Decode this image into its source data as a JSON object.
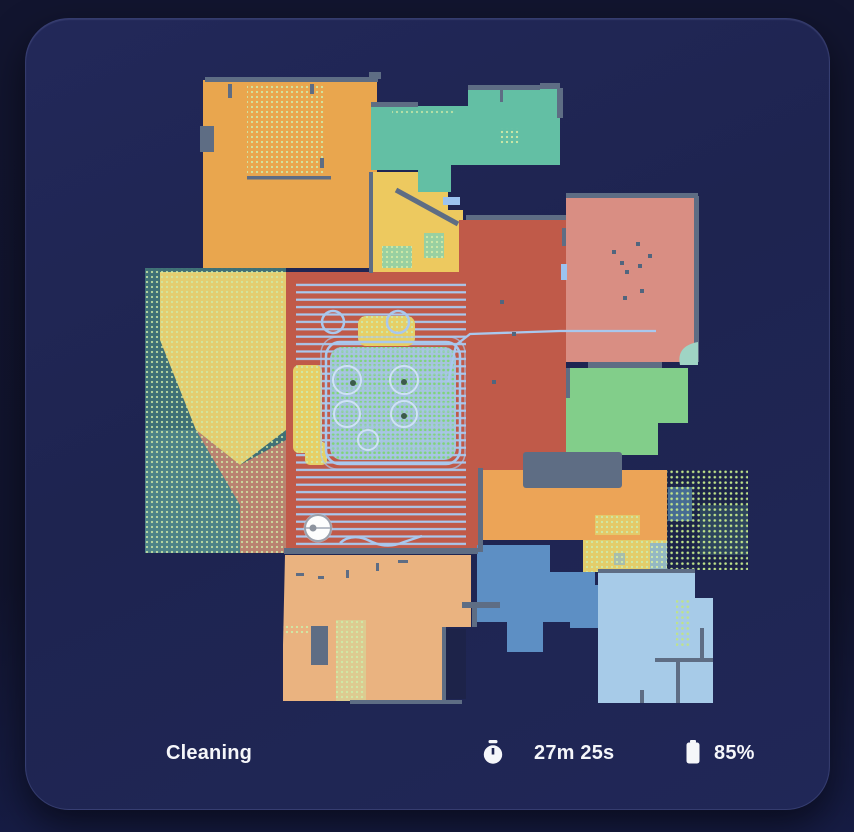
{
  "status_bar": {
    "state_label": "Cleaning",
    "time_value": "27m 25s",
    "battery_value": "85%"
  },
  "map": {
    "wall_color": "#5e6d84",
    "path_color": "#a9c8ee",
    "carpet_dot_color": "#cfe9a6",
    "bright_dot_color": "#bfe38a",
    "robot": {
      "x": 318,
      "y": 528,
      "color": "#fdfdfd"
    },
    "rooms": [
      {
        "name": "room-orange-top-left",
        "color": "#e9a64e"
      },
      {
        "name": "room-teal-top",
        "color": "#63bfa4"
      },
      {
        "name": "room-yellow",
        "color": "#edc95f"
      },
      {
        "name": "room-red-center",
        "color": "#c05a49"
      },
      {
        "name": "room-pink-right",
        "color": "#d98e83"
      },
      {
        "name": "room-green-right",
        "color": "#82ce8a"
      },
      {
        "name": "room-orange-strip",
        "color": "#eca457"
      },
      {
        "name": "room-blue-mid",
        "color": "#5d8fc4"
      },
      {
        "name": "room-light-blue",
        "color": "#a7cbe8"
      },
      {
        "name": "room-peach-bottom",
        "color": "#eab380"
      }
    ],
    "zones": [
      {
        "name": "carpet-zone-left",
        "base_color": "#3f7076"
      },
      {
        "name": "carpet-zone-right",
        "base_color": "#1c2448"
      },
      {
        "name": "carpet-strip-yellow",
        "base_color": "#e3cd6a"
      }
    ]
  }
}
